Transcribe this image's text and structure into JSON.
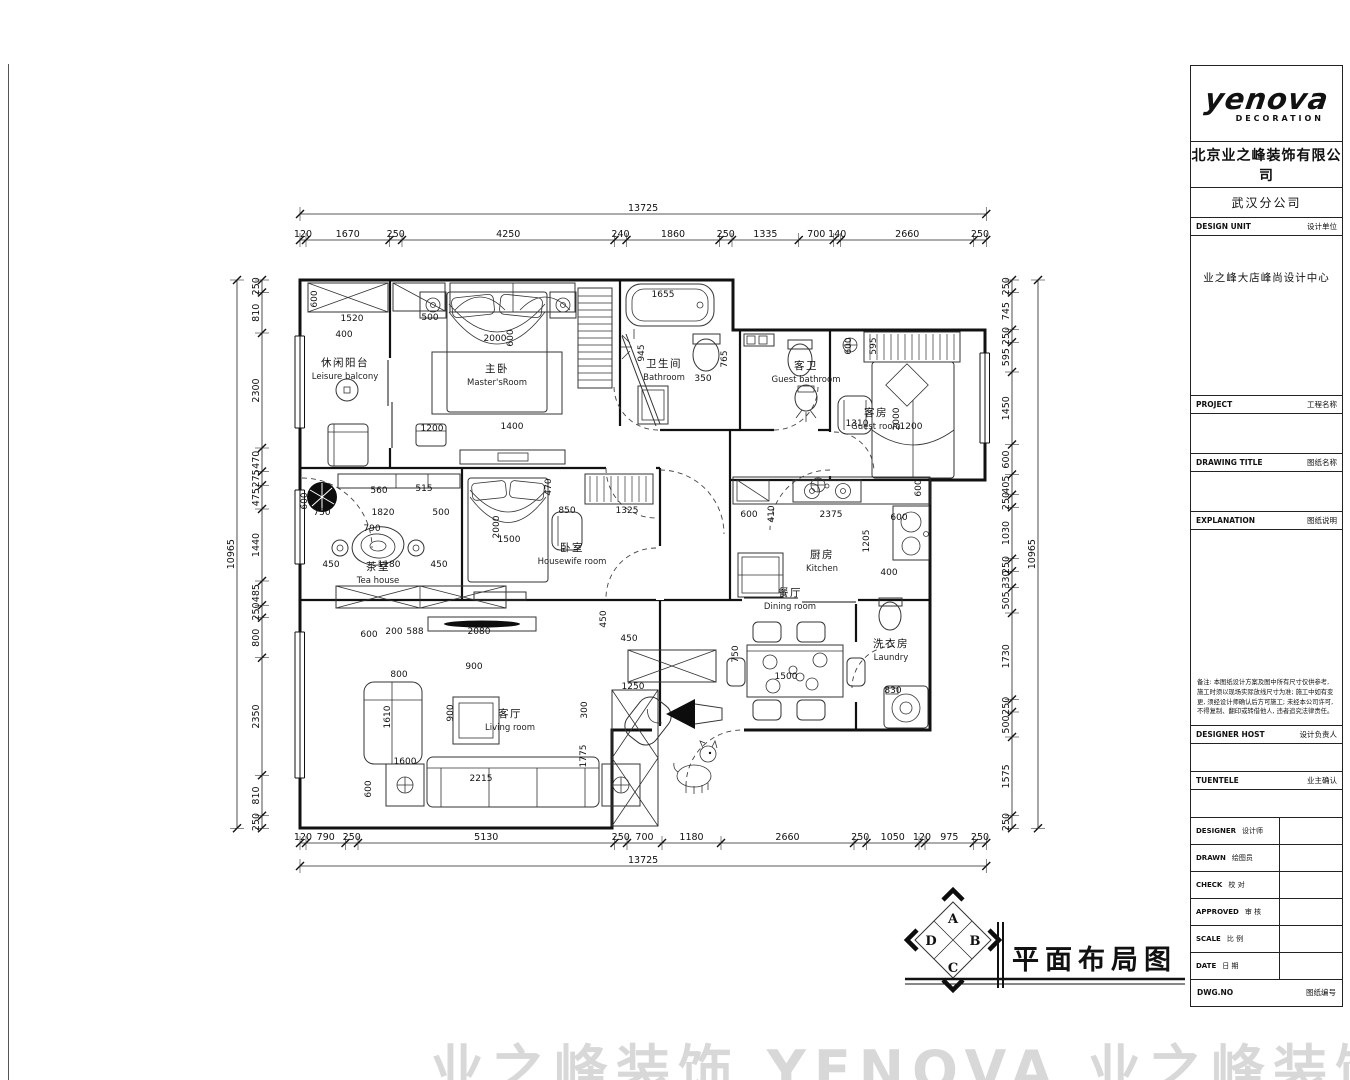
{
  "titleblock": {
    "logo": {
      "brand": "yenova",
      "sub": "DECORATION"
    },
    "company": {
      "cn": "北京业之峰装饰有限公司",
      "en": "BEIJING YEZHIFENG DECORATION CO., LTD",
      "tagline": "中国建筑装饰协会会员单位 全国住宅装饰装修优秀企业"
    },
    "branch": "武汉分公司",
    "design_unit": {
      "en": "DESIGN UNIT",
      "cn": "设计单位",
      "value": "业之峰大店峰尚设计中心"
    },
    "project": {
      "en": "PROJECT",
      "cn": "工程名称"
    },
    "drawing_title": {
      "en": "DRAWING TITLE",
      "cn": "图纸名称"
    },
    "explanation": {
      "en": "EXPLANATION",
      "cn": "图纸说明"
    },
    "note_title": "备注:",
    "note": "本图纸设计方案及图中所有尺寸仅供参考, 施工时须以现场实际放线尺寸为准; 施工中如有变更, 须经设计师确认后方可施工; 未经本公司许可, 不得复制、翻印或转借他人, 违者追究法律责任。",
    "designer_host": {
      "en": "DESIGNER HOST",
      "cn": "设计负责人"
    },
    "tuentele": {
      "en": "TUENTELE",
      "cn": "业主确认"
    },
    "small_rows": [
      {
        "en": "DESIGNER",
        "cn": "设计师"
      },
      {
        "en": "DRAWN",
        "cn": "绘图员"
      },
      {
        "en": "CHECK",
        "cn": "校 对"
      },
      {
        "en": "APPROVED",
        "cn": "审 核"
      },
      {
        "en": "SCALE",
        "cn": "比 例"
      },
      {
        "en": "DATE",
        "cn": "日 期"
      }
    ],
    "dwg_row": {
      "en": "DWG.NO",
      "cn": "图纸编号"
    }
  },
  "footer": {
    "title": "平面布局图",
    "compass": {
      "top": "A",
      "right": "B",
      "bottom": "C",
      "left": "D"
    }
  },
  "watermark": "业之峰装饰 YENOVA 业之峰装饰",
  "plan": {
    "rooms": [
      {
        "cn": "休闲阳台",
        "en": "Leisure balcony",
        "x": 345,
        "y": 366
      },
      {
        "cn": "主卧",
        "en": "Master'sRoom",
        "x": 497,
        "y": 372
      },
      {
        "cn": "卫生间",
        "en": "Bathroom",
        "x": 664,
        "y": 367
      },
      {
        "cn": "客卫",
        "en": "Guest bathroom",
        "x": 806,
        "y": 369
      },
      {
        "cn": "客房",
        "en": "Guest room",
        "x": 876,
        "y": 416
      },
      {
        "cn": "茶室",
        "en": "Tea house",
        "x": 378,
        "y": 570
      },
      {
        "cn": "卧室",
        "en": "Housewife room",
        "x": 572,
        "y": 551
      },
      {
        "cn": "厨房",
        "en": "Kitchen",
        "x": 822,
        "y": 558
      },
      {
        "cn": "餐厅",
        "en": "Dining room",
        "x": 790,
        "y": 596
      },
      {
        "cn": "洗衣房",
        "en": "Laundry",
        "x": 891,
        "y": 647
      },
      {
        "cn": "客厅",
        "en": "Living room",
        "x": 510,
        "y": 717
      }
    ],
    "dimension_chains": [
      {
        "id": "top",
        "axis": "h",
        "total": "13725",
        "from": 300,
        "line": 240,
        "totalLine": 214,
        "segments": [
          "120",
          "1670",
          "250",
          "4250",
          "240",
          "1860",
          "250",
          "1335",
          "700",
          "140",
          "2660",
          "250"
        ]
      },
      {
        "id": "bottom",
        "axis": "h",
        "total": "13725",
        "from": 300,
        "line": 843,
        "totalLine": 866,
        "segments": [
          "120",
          "790",
          "250",
          "5130",
          "250",
          "700",
          "1180",
          "2660",
          "250",
          "1050",
          "120",
          "975",
          "250"
        ]
      },
      {
        "id": "left",
        "axis": "v",
        "total": "10965",
        "from": 280,
        "line": 262,
        "totalLine": 237,
        "segments": [
          "250",
          "810",
          "2300",
          "470",
          "275",
          "475",
          "1440",
          "485",
          "250",
          "800",
          "2350",
          "810",
          "250"
        ]
      },
      {
        "id": "right",
        "axis": "v",
        "total": "10965",
        "from": 280,
        "line": 1012,
        "totalLine": 1038,
        "segments": [
          "250",
          "745",
          "250",
          "595",
          "1450",
          "600",
          "405",
          "250",
          "1030",
          "250",
          "330",
          "505",
          "1730",
          "250",
          "500",
          "1575",
          "250"
        ]
      }
    ],
    "inline_dims": [
      {
        "v": "1520",
        "x": 352,
        "y": 321
      },
      {
        "v": "600",
        "x": 317,
        "y": 299,
        "r": -90
      },
      {
        "v": "500",
        "x": 430,
        "y": 320
      },
      {
        "v": "2000",
        "x": 495,
        "y": 341
      },
      {
        "v": "600",
        "x": 513,
        "y": 338,
        "r": -90
      },
      {
        "v": "1400",
        "x": 512,
        "y": 429
      },
      {
        "v": "1200",
        "x": 432,
        "y": 431
      },
      {
        "v": "400",
        "x": 344,
        "y": 337
      },
      {
        "v": "1655",
        "x": 663,
        "y": 297
      },
      {
        "v": "350",
        "x": 703,
        "y": 381
      },
      {
        "v": "945",
        "x": 644,
        "y": 353,
        "r": -90
      },
      {
        "v": "765",
        "x": 727,
        "y": 359,
        "r": -90
      },
      {
        "v": "600",
        "x": 851,
        "y": 346,
        "r": -90
      },
      {
        "v": "595",
        "x": 876,
        "y": 346,
        "r": -90
      },
      {
        "v": "1310",
        "x": 857,
        "y": 426
      },
      {
        "v": "1200",
        "x": 911,
        "y": 429
      },
      {
        "v": "2000",
        "x": 899,
        "y": 419,
        "r": -90
      },
      {
        "v": "750",
        "x": 322,
        "y": 515
      },
      {
        "v": "1820",
        "x": 383,
        "y": 515
      },
      {
        "v": "500",
        "x": 441,
        "y": 515
      },
      {
        "v": "560",
        "x": 379,
        "y": 493
      },
      {
        "v": "515",
        "x": 424,
        "y": 491
      },
      {
        "v": "790",
        "x": 372,
        "y": 531
      },
      {
        "v": "450",
        "x": 331,
        "y": 567
      },
      {
        "v": "1180",
        "x": 389,
        "y": 567
      },
      {
        "v": "450",
        "x": 439,
        "y": 567
      },
      {
        "v": "600",
        "x": 307,
        "y": 501,
        "r": -90
      },
      {
        "v": "1500",
        "x": 509,
        "y": 542
      },
      {
        "v": "2000",
        "x": 499,
        "y": 527,
        "r": -90
      },
      {
        "v": "470",
        "x": 551,
        "y": 487,
        "r": -90
      },
      {
        "v": "850",
        "x": 567,
        "y": 513
      },
      {
        "v": "1325",
        "x": 627,
        "y": 513
      },
      {
        "v": "600",
        "x": 749,
        "y": 517
      },
      {
        "v": "410",
        "x": 774,
        "y": 514,
        "r": -90
      },
      {
        "v": "2375",
        "x": 831,
        "y": 517
      },
      {
        "v": "600",
        "x": 921,
        "y": 488,
        "r": -90
      },
      {
        "v": "600",
        "x": 899,
        "y": 520
      },
      {
        "v": "1205",
        "x": 869,
        "y": 541,
        "r": -90
      },
      {
        "v": "400",
        "x": 889,
        "y": 575
      },
      {
        "v": "750",
        "x": 738,
        "y": 654,
        "r": -90
      },
      {
        "v": "1500",
        "x": 786,
        "y": 679
      },
      {
        "v": "830",
        "x": 893,
        "y": 693
      },
      {
        "v": "600",
        "x": 369,
        "y": 637
      },
      {
        "v": "200",
        "x": 394,
        "y": 634
      },
      {
        "v": "588",
        "x": 415,
        "y": 634
      },
      {
        "v": "2080",
        "x": 479,
        "y": 634
      },
      {
        "v": "900",
        "x": 474,
        "y": 669
      },
      {
        "v": "900",
        "x": 453,
        "y": 713,
        "r": -90
      },
      {
        "v": "800",
        "x": 399,
        "y": 677
      },
      {
        "v": "1610",
        "x": 390,
        "y": 717,
        "r": -90
      },
      {
        "v": "1600",
        "x": 405,
        "y": 764
      },
      {
        "v": "600",
        "x": 371,
        "y": 789,
        "r": -90
      },
      {
        "v": "2215",
        "x": 481,
        "y": 781
      },
      {
        "v": "1250",
        "x": 633,
        "y": 689
      },
      {
        "v": "1775",
        "x": 586,
        "y": 756,
        "r": -90
      },
      {
        "v": "450",
        "x": 606,
        "y": 619,
        "r": -90
      },
      {
        "v": "450",
        "x": 629,
        "y": 641
      },
      {
        "v": "300",
        "x": 587,
        "y": 710,
        "r": -90
      }
    ]
  }
}
